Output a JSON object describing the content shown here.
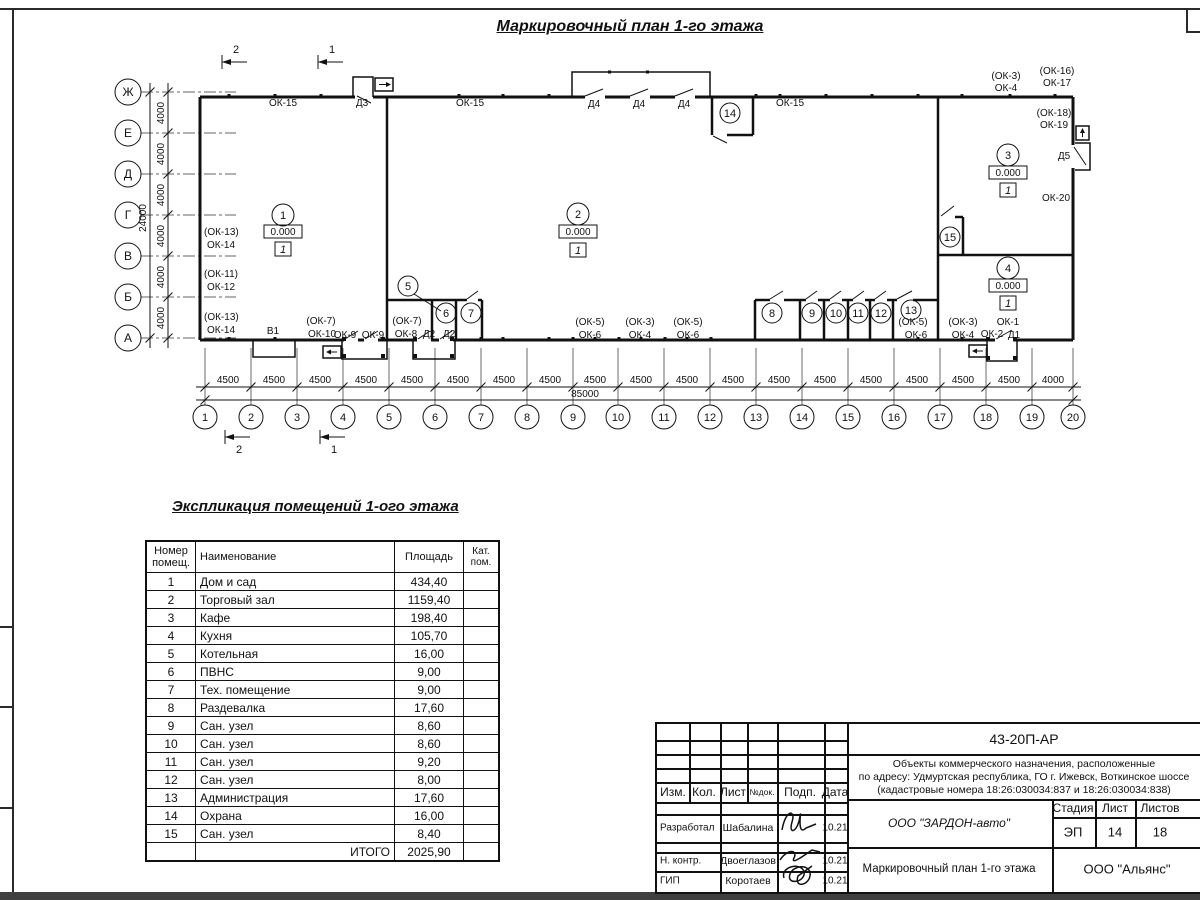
{
  "sheet": {
    "title": "Маркировочный план 1-го этажа"
  },
  "plan": {
    "axis_rows": [
      "Ж",
      "Е",
      "Д",
      "Г",
      "В",
      "Б",
      "А"
    ],
    "row_dims": [
      "4000",
      "4000",
      "4000",
      "4000",
      "4000",
      "4000"
    ],
    "row_total": "24000",
    "columns": [
      "1",
      "2",
      "3",
      "4",
      "5",
      "6",
      "7",
      "8",
      "9",
      "10",
      "11",
      "12",
      "13",
      "14",
      "15",
      "16",
      "17",
      "18",
      "19",
      "20"
    ],
    "bay_dims": [
      "4500",
      "4500",
      "4500",
      "4500",
      "4500",
      "4500",
      "4500",
      "4500",
      "4500",
      "4500",
      "4500",
      "4500",
      "4500",
      "4500",
      "4500",
      "4500",
      "4500",
      "4500",
      "4000"
    ],
    "bay_total": "85000",
    "sections": {
      "n1": "1",
      "n2": "2"
    },
    "rooms": [
      {
        "num": "1",
        "elev": "0.000",
        "mark": "1"
      },
      {
        "num": "2",
        "elev": "0.000",
        "mark": "1"
      },
      {
        "num": "3",
        "elev": "0.000",
        "mark": "1"
      },
      {
        "num": "4",
        "elev": "0.000",
        "mark": "1"
      },
      {
        "num": "5"
      },
      {
        "num": "6"
      },
      {
        "num": "7"
      },
      {
        "num": "8"
      },
      {
        "num": "9"
      },
      {
        "num": "10"
      },
      {
        "num": "11"
      },
      {
        "num": "12"
      },
      {
        "num": "13"
      },
      {
        "num": "14"
      },
      {
        "num": "15"
      }
    ],
    "annotations": [
      "ОК-15",
      "Д3",
      "ОК-15",
      "Д4",
      "Д4",
      "Д4",
      "ОК-15",
      "(ОК-3)",
      "ОК-4",
      "(ОК-16)",
      "ОК-17",
      "(ОК-18)",
      "ОК-19",
      "Д5",
      "ОК-20",
      "(ОК-13)",
      "ОК-14",
      "(ОК-11)",
      "ОК-12",
      "(ОК-13)",
      "ОК-14",
      "В1",
      "(ОК-7)",
      "ОК-10",
      "ОК-9",
      "ОК-9",
      "(ОК-7)",
      "ОК-8",
      "Д2",
      "Д2",
      "(ОК-5)",
      "ОК-6",
      "(ОК-3)",
      "ОК-4",
      "(ОК-5)",
      "ОК-6",
      "(ОК-5)",
      "ОК-6",
      "(ОК-3)",
      "ОК-4",
      "ОК-2",
      "ОК-1",
      "Д1"
    ]
  },
  "explication": {
    "title": "Экспликация помещений 1-ого этажа",
    "headers": [
      "Номер помещ.",
      "Наименование",
      "Площадь",
      "Кат. пом."
    ],
    "rows": [
      {
        "num": "1",
        "name": "Дом и сад",
        "area": "434,40",
        "kat": ""
      },
      {
        "num": "2",
        "name": "Торговый зал",
        "area": "1159,40",
        "kat": ""
      },
      {
        "num": "3",
        "name": "Кафе",
        "area": "198,40",
        "kat": ""
      },
      {
        "num": "4",
        "name": "Кухня",
        "area": "105,70",
        "kat": ""
      },
      {
        "num": "5",
        "name": "Котельная",
        "area": "16,00",
        "kat": ""
      },
      {
        "num": "6",
        "name": "ПВНС",
        "area": "9,00",
        "kat": ""
      },
      {
        "num": "7",
        "name": "Тех. помещение",
        "area": "9,00",
        "kat": ""
      },
      {
        "num": "8",
        "name": "Раздевалка",
        "area": "17,60",
        "kat": ""
      },
      {
        "num": "9",
        "name": "Сан. узел",
        "area": "8,60",
        "kat": ""
      },
      {
        "num": "10",
        "name": "Сан. узел",
        "area": "8,60",
        "kat": ""
      },
      {
        "num": "11",
        "name": "Сан. узел",
        "area": "9,20",
        "kat": ""
      },
      {
        "num": "12",
        "name": "Сан. узел",
        "area": "8,00",
        "kat": ""
      },
      {
        "num": "13",
        "name": "Администрация",
        "area": "17,60",
        "kat": ""
      },
      {
        "num": "14",
        "name": "Охрана",
        "area": "16,00",
        "kat": ""
      },
      {
        "num": "15",
        "name": "Сан. узел",
        "area": "8,40",
        "kat": ""
      }
    ],
    "total_label": "ИТОГО",
    "total_value": "2025,90"
  },
  "titleblock": {
    "doc_number": "43-20П-АР",
    "address_line1": "Объекты коммерческого назначения, расположенные",
    "address_line2": "по адресу: Удмуртская республика, ГО г. Ижевск, Воткинское шоссе",
    "address_line3": "(кадастровые номера 18:26:030034:837 и 18:26:030034:838)",
    "cols": {
      "izm": "Изм.",
      "kol": "Кол.",
      "list": "Лист",
      "ndoc": "№док.",
      "podp": "Подп.",
      "data": "Дата"
    },
    "roles": [
      {
        "role": "Разработал",
        "name": "Шабалина",
        "date": "10.21"
      },
      {
        "role": "Н. контр.",
        "name": "Двоеглазов",
        "date": "10.21"
      },
      {
        "role": "ГИП",
        "name": "Коротаев",
        "date": "10.21"
      }
    ],
    "org": "ООО \"ЗАРДОН-авто\"",
    "stage_label": "Стадия",
    "sheet_label": "Лист",
    "sheets_label": "Листов",
    "stage": "ЭП",
    "sheet_num": "14",
    "sheets_num": "18",
    "drawing_name": "Маркировочный план 1-го этажа",
    "company": "ООО \"Альянс\""
  }
}
